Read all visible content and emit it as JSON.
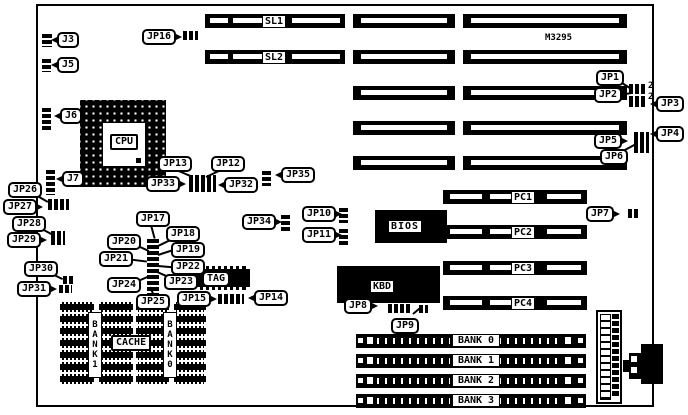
{
  "board": {
    "model": "M3295"
  },
  "connectors": {
    "j3": "J3",
    "j5": "J5",
    "j6": "J6",
    "j7": "J7"
  },
  "jumpers": {
    "jp1": "JP1",
    "jp2": "JP2",
    "jp3": "JP3",
    "jp4": "JP4",
    "jp5": "JP5",
    "jp6": "JP6",
    "jp7": "JP7",
    "jp8": "JP8",
    "jp9": "JP9",
    "jp10": "JP10",
    "jp11": "JP11",
    "jp12": "JP12",
    "jp13": "JP13",
    "jp14": "JP14",
    "jp15": "JP15",
    "jp16": "JP16",
    "jp17": "JP17",
    "jp18": "JP18",
    "jp19": "JP19",
    "jp20": "JP20",
    "jp21": "JP21",
    "jp22": "JP22",
    "jp23": "JP23",
    "jp24": "JP24",
    "jp25": "JP25",
    "jp26": "JP26",
    "jp27": "JP27",
    "jp28": "JP28",
    "jp29": "JP29",
    "jp30": "JP30",
    "jp31": "JP31",
    "jp32": "JP32",
    "jp33": "JP33",
    "jp34": "JP34",
    "jp35": "JP35"
  },
  "slots": {
    "sl1": "SL1",
    "sl2": "SL2",
    "pc1": "PC1",
    "pc2": "PC2",
    "pc3": "PC3",
    "pc4": "PC4"
  },
  "chips": {
    "cpu": "CPU",
    "bios": "BIOS",
    "kbd": "KBD",
    "tag": "TAG",
    "cache": "CACHE",
    "cache_bank1": "BANK1",
    "cache_bank0": "BANK0"
  },
  "memory": {
    "banks": [
      "BANK 0",
      "BANK 1",
      "BANK 2",
      "BANK 3"
    ]
  },
  "pin_markers": {
    "jp1_pin2": "2",
    "jp2_pin2": "2"
  },
  "colors": {
    "line": "#000000",
    "background": "#ffffff"
  }
}
